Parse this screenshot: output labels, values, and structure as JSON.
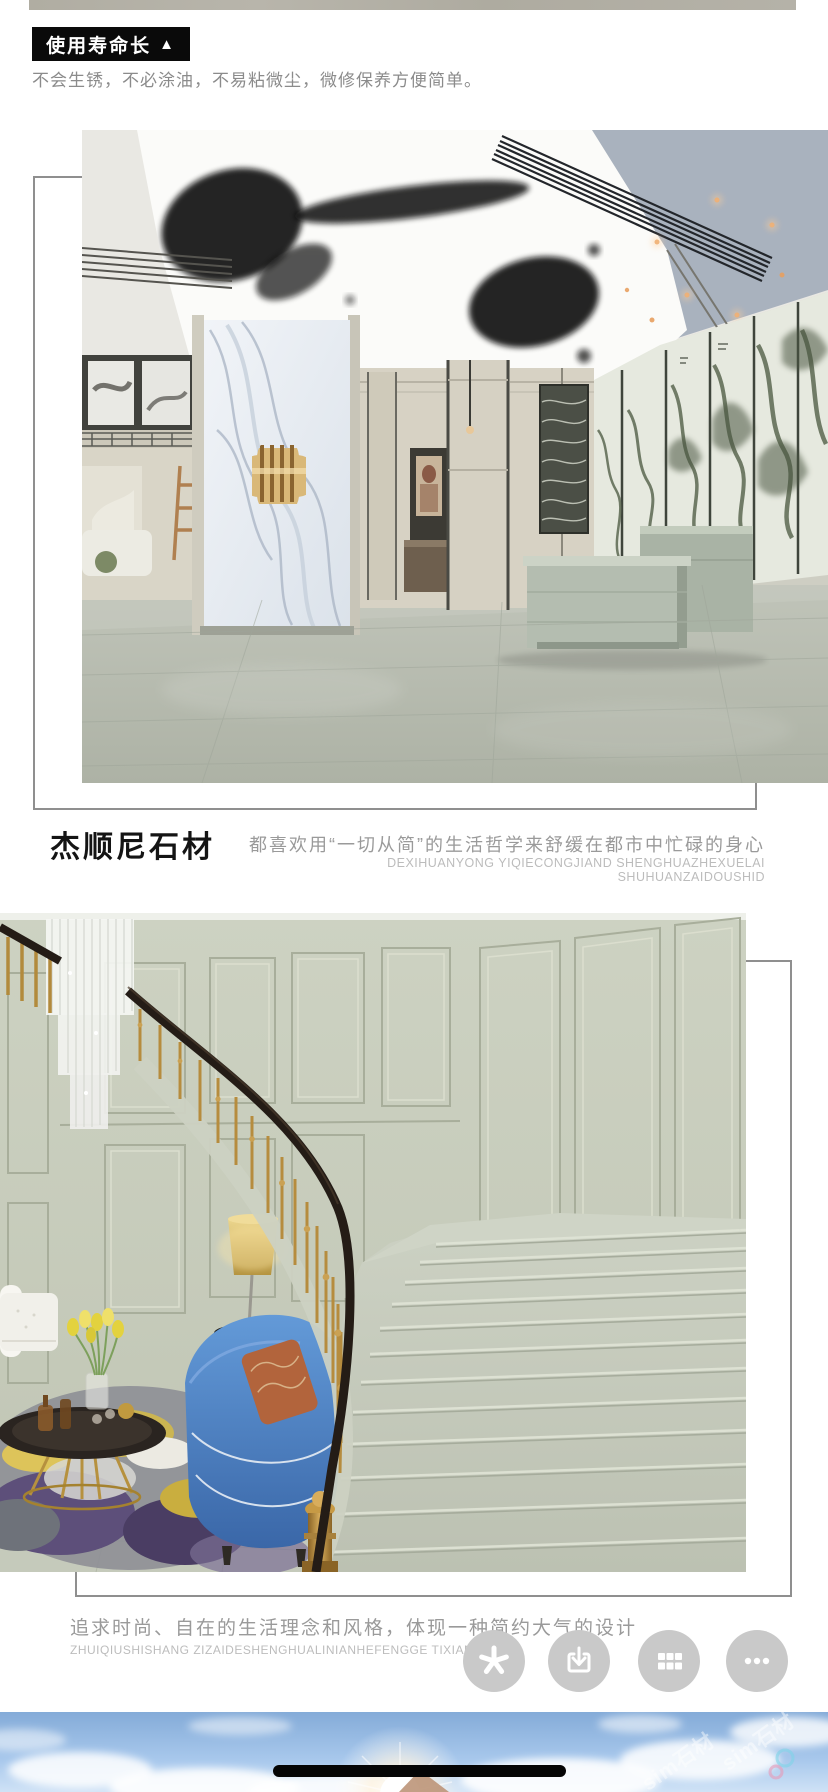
{
  "feature_section": {
    "badge_label": "使用寿命长",
    "badge_arrow": "▲",
    "description": "不会生锈，不必涂油，不易粘微尘，微修保养方便简单。"
  },
  "brand_section": {
    "brand_name": "杰顺尼石材",
    "description": "都喜欢用“一切从简”的生活哲学来舒缓在都市中忙碌的身心",
    "pinyin": "DEXIHUANYONG YIQIECONGJIAND SHENGHUAZHEXUELAI SHUHUANZAIDOUSHID"
  },
  "style_section": {
    "description": "追求时尚、自在的生活理念和风格，体现一种简约大气的设计",
    "pinyin": "ZHUIQIUSHISHANG ZIZAIDESHENGHUALINIANHEFENGGE TIXIANYIZHO"
  },
  "floating_toolbar": {
    "buttons": [
      {
        "icon": "asterisk-icon"
      },
      {
        "icon": "download-icon"
      },
      {
        "icon": "grid-icon"
      },
      {
        "icon": "ellipsis-icon"
      }
    ],
    "button_bg": "#c9c9c9",
    "icon_color": "#ffffff"
  },
  "sky_footer": {
    "watermark": "sim石材"
  },
  "colors": {
    "badge_bg": "#0a0a0a",
    "badge_text": "#ffffff",
    "body_text_gray": "#8b8b8b",
    "pinyin_gray": "#bcbcbc",
    "heading_black": "#141414",
    "frame_line": "#8f8f8f",
    "floor_sage": "#b5b9ae",
    "wall_sage": "#c9cebd",
    "sky_blue": "#8fb3de"
  }
}
